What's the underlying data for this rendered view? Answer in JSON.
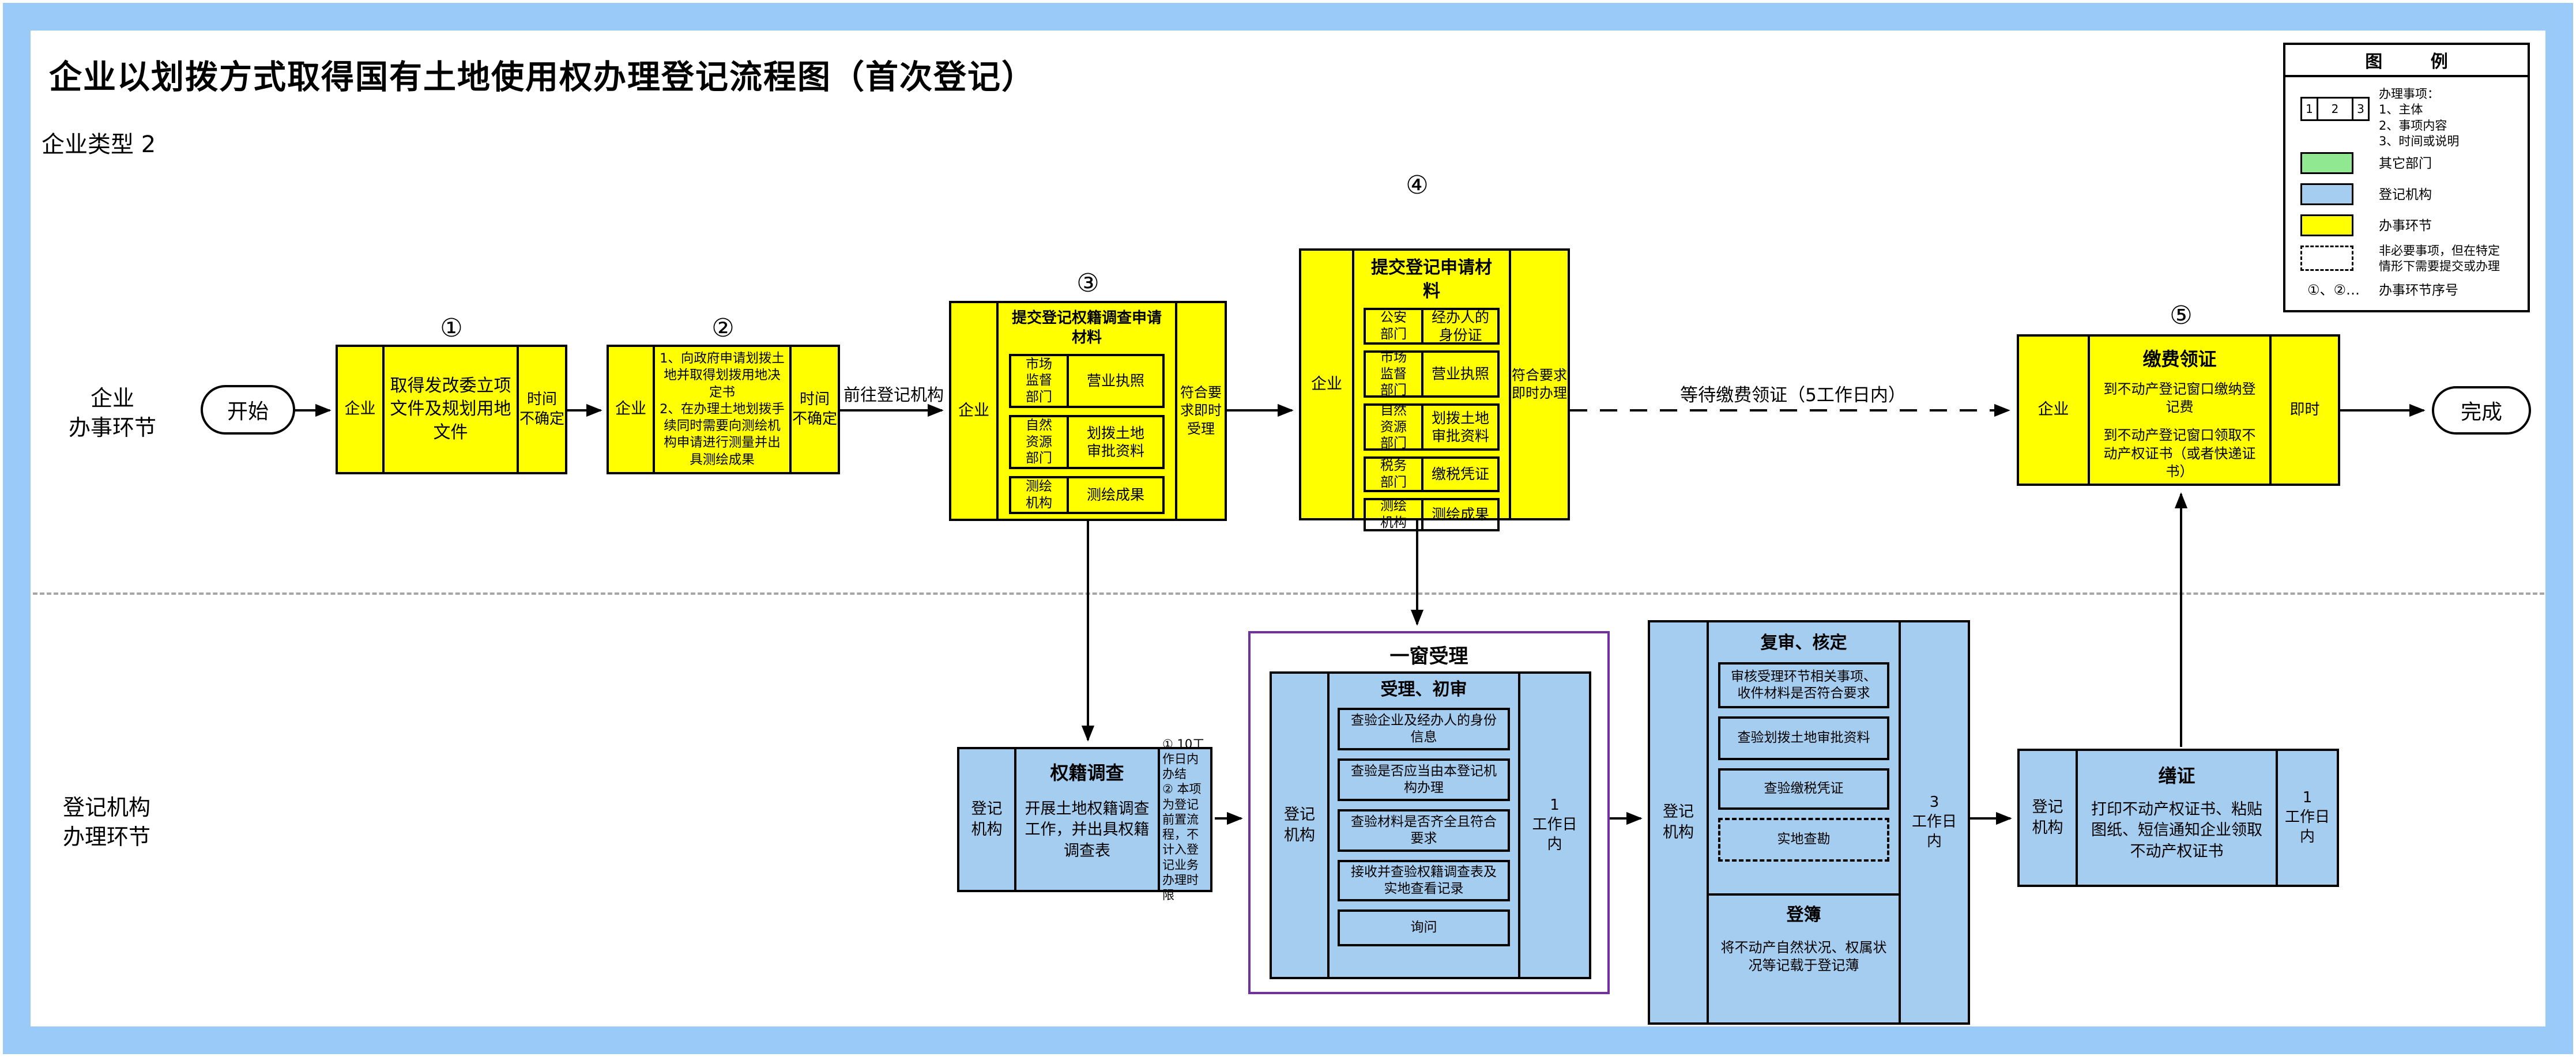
{
  "page": {
    "title": "企业以划拨方式取得国有土地使用权办理登记流程图（首次登记）",
    "subtitle": "企业类型 2"
  },
  "lanes": {
    "lane1": "企业\n办事环节",
    "lane2": "登记机构\n办理环节"
  },
  "terminals": {
    "start": "开始",
    "end": "完成"
  },
  "edges": {
    "to_registry": "前往登记机构",
    "wait_cert": "等待缴费领证（5工作日内）"
  },
  "steps": {
    "s1": {
      "num": "①",
      "actor": "企业",
      "content": "取得发改委立项文件及规划用地文件",
      "time": "时间\n不确定"
    },
    "s2": {
      "num": "②",
      "actor": "企业",
      "content": "1、向政府申请划拨土地并取得划拨用地决定书\n2、在办理土地划拨手续同时需要向测绘机构申请进行测量并出具测绘成果",
      "time": "时间\n不确定"
    },
    "s3": {
      "num": "③",
      "actor": "企业",
      "title": "提交登记权籍调查申请材料",
      "rows": [
        {
          "dept": "市场\n监督\n部门",
          "doc": "营业执照"
        },
        {
          "dept": "自然\n资源\n部门",
          "doc": "划拨土地\n审批资料"
        },
        {
          "dept": "测绘\n机构",
          "doc": "测绘成果"
        }
      ],
      "time": "符合要\n求即时\n受理"
    },
    "s4": {
      "num": "④",
      "actor": "企业",
      "title": "提交登记申请材料",
      "rows": [
        {
          "dept": "公安\n部门",
          "doc": "经办人的\n身份证"
        },
        {
          "dept": "市场\n监督\n部门",
          "doc": "营业执照"
        },
        {
          "dept": "自然\n资源\n部门",
          "doc": "划拨土地\n审批资料"
        },
        {
          "dept": "税务\n部门",
          "doc": "缴税凭证"
        },
        {
          "dept": "测绘\n机构",
          "doc": "测绘成果"
        }
      ],
      "time": "符合要求\n即时办理"
    },
    "s5": {
      "num": "⑤",
      "actor": "企业",
      "title": "缴费领证",
      "line1": "到不动产登记窗口缴纳登记费",
      "line2": "到不动产登记窗口领取不动产权证书（或者快递证书）",
      "time": "即时"
    }
  },
  "registry": {
    "survey": {
      "actor": "登记\n机构",
      "title": "权籍调查",
      "content": "开展土地权籍调查工作，并出具权籍调查表",
      "note": "① 10工作日内办结\n② 本项为登记前置流程，不计入登记业务办理时限"
    },
    "one_window": {
      "label": "一窗受理",
      "actor": "登记\n机构",
      "title": "受理、初审",
      "items": [
        "查验企业及经办人的身份信息",
        "查验是否应当由本登记机构办理",
        "查验材料是否齐全且符合要求",
        "接收并查验权籍调查表及实地查看记录",
        "询问"
      ],
      "time": "1\n工作日\n内"
    },
    "review": {
      "actor": "登记\n机构",
      "title": "复审、核定",
      "items": [
        "审核受理环节相关事项、收件材料是否符合要求",
        "查验划拨土地审批资料",
        "查验缴税凭证"
      ],
      "optional_item": "实地查勘",
      "book_title": "登簿",
      "book_text": "将不动产自然状况、权属状况等记载于登记薄",
      "time": "3\n工作日\n内"
    },
    "cert": {
      "actor": "登记\n机构",
      "title": "缮证",
      "content": "打印不动产权证书、粘贴图纸、短信通知企业领取不动产权证书",
      "time": "1\n工作日\n内"
    }
  },
  "legend": {
    "header": "图        例",
    "sample": {
      "c1": "1",
      "c2": "2",
      "c3": "3"
    },
    "sample_note": "办理事项：\n1、主体\n2、事项内容\n3、时间或说明",
    "items": [
      {
        "label": "其它部门"
      },
      {
        "label": "登记机构"
      },
      {
        "label": "办事环节"
      },
      {
        "label": "非必要事项，但在特定\n情形下需要提交或办理"
      },
      {
        "glyph": "①、②…",
        "label": "办事环节序号"
      }
    ]
  },
  "colors": {
    "yellow": "#FFFF00",
    "blue": "#A5CDF0",
    "green": "#90E890",
    "frame": "#99CAF8",
    "purple": "#7030A0"
  }
}
